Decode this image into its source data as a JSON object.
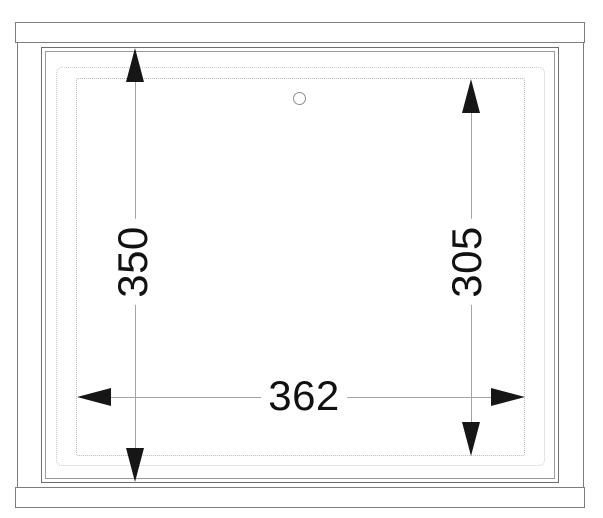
{
  "drawing": {
    "kind": "technical-elevation-drawing",
    "dimensions": {
      "frame_height_left": "350",
      "opening_height_right": "305",
      "opening_width_bottom": "362"
    },
    "features": {
      "hole": "drill-hole"
    },
    "colors": {
      "background": "#ffffff",
      "rail_line": "#7d7d7d",
      "frame_line_outer": "#6e6e6e",
      "frame_line_inner": "#9a9a9a",
      "dotted_outline": "#b8b8b8",
      "dimension_line": "#a5a5a5",
      "arrow": "#161616",
      "text": "#111111"
    }
  }
}
